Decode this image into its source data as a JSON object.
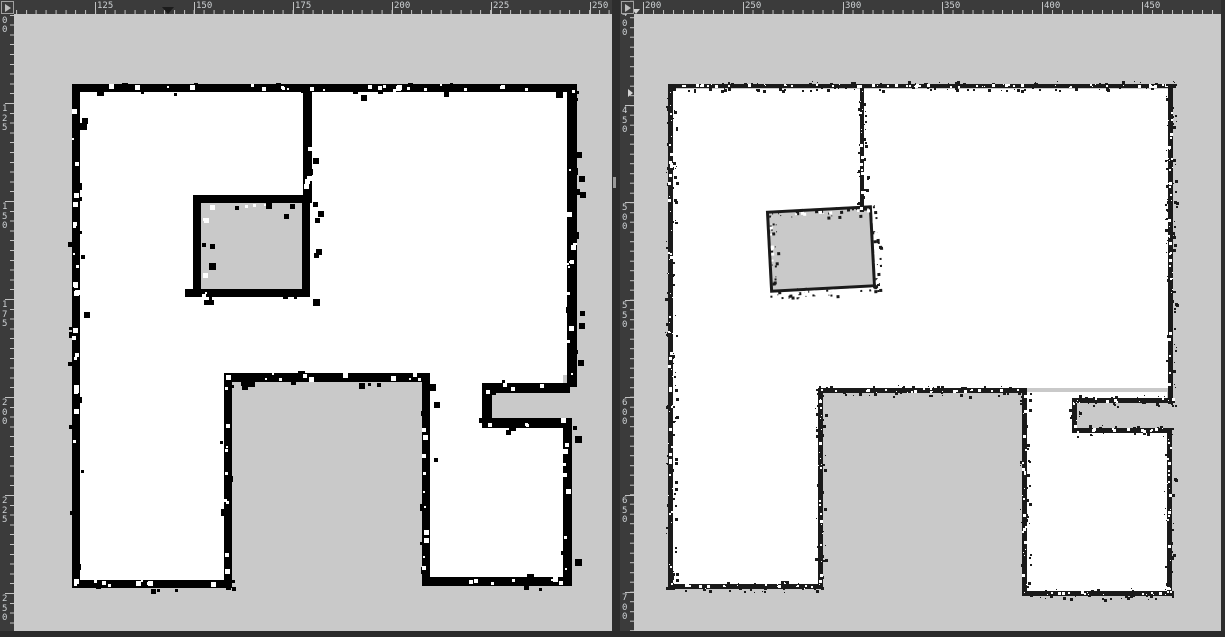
{
  "colors": {
    "workspace_bg": "#2d2d2d",
    "ruler_bg": "#3b3b3b",
    "ruler_tick": "#c2c2c2",
    "ruler_label": "#ced2d5",
    "canvas_unknown": "#c9c9c9",
    "map_free_space": "#ffffff",
    "wall_left_map": "#000000",
    "wall_right_map": "#1a1a1a",
    "divider": "#2d2d2d",
    "scroll_thumb": "#9a9a9a",
    "marker_dark": "#1c1c1c",
    "marker_light": "#d2d2d2"
  },
  "workspace": {
    "width": 1225,
    "height": 637,
    "divider": {
      "x": 612,
      "w": 8,
      "thumb_y": 177,
      "thumb_h": 11
    },
    "right_edge": {
      "x": 1221,
      "w": 4
    },
    "bottom_strip": {
      "y": 631,
      "h": 6
    }
  },
  "panels": [
    {
      "name": "map-view-left",
      "x": 0,
      "width": 612,
      "corner_icon": "play-triangle-icon",
      "h_ruler": {
        "minor_period": 9.88,
        "ticks": [
          {
            "label": "125",
            "x": 95
          },
          {
            "label": "150",
            "x": 194
          },
          {
            "label": "175",
            "x": 293
          },
          {
            "label": "200",
            "x": 392
          },
          {
            "label": "225",
            "x": 491
          },
          {
            "label": "250",
            "x": 590
          }
        ],
        "marker": {
          "x": 168,
          "style": "dark"
        }
      },
      "v_ruler": {
        "minor_period": 9.8,
        "ticks": [
          {
            "label": "100",
            "y": 5
          },
          {
            "label": "125",
            "y": 103
          },
          {
            "label": "150",
            "y": 201
          },
          {
            "label": "175",
            "y": 299
          },
          {
            "label": "200",
            "y": 397
          },
          {
            "label": "225",
            "y": 495
          },
          {
            "label": "250",
            "y": 593
          }
        ]
      },
      "map": {
        "wall_color": "#000000",
        "speckle_seed": 1337,
        "speckle": {
          "dark_density": 0.045,
          "dark_min": 3,
          "dark_max": 7,
          "light_density": 0.05,
          "light_min": 2,
          "light_max": 5,
          "jitter": 4
        },
        "white_regions": [
          [
            66,
            78,
            487,
            283
          ],
          [
            66,
            359,
            144,
            209
          ],
          [
            416,
            359,
            133,
            206
          ]
        ],
        "gray_regions": [
          [
            478,
            379,
            122,
            25
          ]
        ],
        "inner_room": {
          "x": 179,
          "y": 181,
          "w": 117,
          "h": 102,
          "border": 8,
          "rotate": 0
        },
        "walls": [
          [
            66,
            70,
            497,
            8
          ],
          [
            58,
            70,
            8,
            504
          ],
          [
            58,
            566,
            160,
            8
          ],
          [
            210,
            359,
            8,
            215
          ],
          [
            210,
            359,
            206,
            9
          ],
          [
            408,
            359,
            8,
            212
          ],
          [
            408,
            563,
            150,
            9
          ],
          [
            549,
            406,
            9,
            166
          ],
          [
            468,
            404,
            90,
            10
          ],
          [
            468,
            369,
            10,
            45
          ],
          [
            473,
            369,
            83,
            10
          ],
          [
            553,
            70,
            10,
            303
          ],
          [
            289,
            74,
            9,
            115
          ],
          [
            171,
            275,
            12,
            8
          ]
        ]
      }
    },
    {
      "name": "map-view-right",
      "x": 620,
      "width": 601,
      "corner_icon": "play-triangle-icon",
      "h_ruler": {
        "minor_period": 9.98,
        "ticks": [
          {
            "label": "200",
            "x": 23
          },
          {
            "label": "250",
            "x": 123
          },
          {
            "label": "300",
            "x": 223
          },
          {
            "label": "350",
            "x": 322
          },
          {
            "label": "400",
            "x": 422
          },
          {
            "label": "450",
            "x": 522
          }
        ],
        "marker": {
          "x": 16,
          "style": "light"
        }
      },
      "v_ruler": {
        "minor_period": 9.73,
        "ticks": [
          {
            "label": "400",
            "y": 8
          },
          {
            "label": "450",
            "y": 105
          },
          {
            "label": "500",
            "y": 202
          },
          {
            "label": "550",
            "y": 300
          },
          {
            "label": "600",
            "y": 397
          },
          {
            "label": "650",
            "y": 495
          },
          {
            "label": "700",
            "y": 592
          }
        ],
        "marker": {
          "y": 93,
          "style": "light"
        }
      },
      "map": {
        "wall_color": "#1a1a1a",
        "speckle_seed": 4242,
        "speckle": {
          "dark_density": 0.28,
          "dark_min": 1,
          "dark_max": 3,
          "light_density": 0.12,
          "light_min": 1,
          "light_max": 3,
          "jitter": 3
        },
        "white_regions": [
          [
            38,
            75,
            496,
            299
          ],
          [
            38,
            374,
            148,
            199
          ],
          [
            393,
            378,
            140,
            199
          ]
        ],
        "gray_regions": [
          [
            443,
            389,
            144,
            25
          ]
        ],
        "inner_room": {
          "x": 134,
          "y": 194,
          "w": 106,
          "h": 82,
          "border": 3,
          "rotate": -3
        },
        "walls": [
          [
            34,
            70,
            508,
            4
          ],
          [
            34,
            70,
            5,
            506
          ],
          [
            34,
            570,
            155,
            5
          ],
          [
            184,
            374,
            5,
            201
          ],
          [
            184,
            374,
            209,
            5
          ],
          [
            388,
            378,
            5,
            203
          ],
          [
            388,
            577,
            152,
            5
          ],
          [
            533,
            418,
            5,
            164
          ],
          [
            438,
            414,
            100,
            5
          ],
          [
            438,
            384,
            5,
            35
          ],
          [
            441,
            384,
            100,
            5
          ],
          [
            534,
            70,
            5,
            320
          ],
          [
            226,
            74,
            4,
            124
          ]
        ]
      }
    }
  ]
}
